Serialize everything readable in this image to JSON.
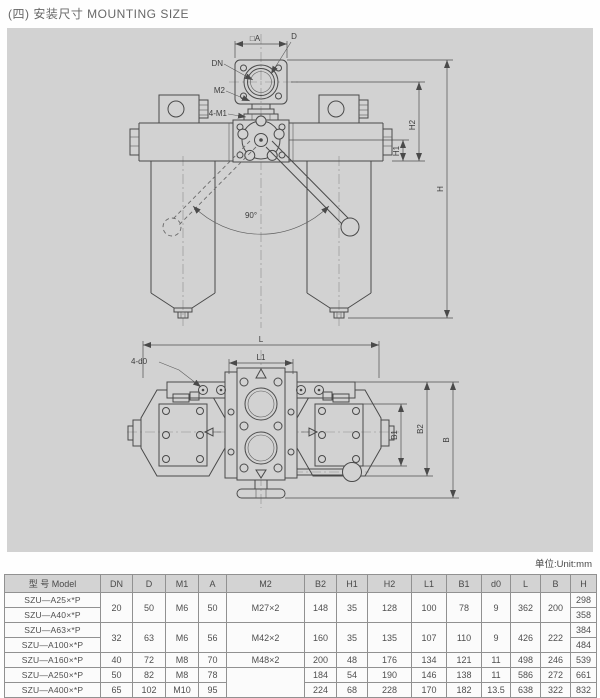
{
  "title": "(四) 安装尺寸 MOUNTING SIZE",
  "unit_note": "单位:Unit:mm",
  "colors": {
    "panel_bg": "#d2d2d2",
    "line": "#4a4a4a",
    "table_border": "#919191",
    "header_bg": "#d3d3d3"
  },
  "drawing": {
    "front_labels": {
      "square_a": "□A",
      "d": "D",
      "dn": "DN",
      "m2": "M2",
      "m1": "4-M1",
      "angle": "90°",
      "h1": "H1",
      "h2": "H2",
      "h": "H"
    },
    "plan_labels": {
      "l": "L",
      "l1": "L1",
      "d0": "4-d0",
      "b1": "B1",
      "b2": "B2",
      "b": "B"
    }
  },
  "table": {
    "headers": {
      "model": "型 号  Model",
      "dn": "DN",
      "d": "D",
      "m1": "M1",
      "a": "A",
      "m2": "M2",
      "b2": "B2",
      "h1": "H1",
      "h2": "H2",
      "l1": "L1",
      "b1": "B1",
      "d0": "d0",
      "l": "L",
      "b": "B",
      "h": "H"
    },
    "r0": {
      "model": "SZU—A25×*P",
      "dn": "20",
      "d": "50",
      "m1": "M6",
      "a": "50",
      "m2": "M27×2",
      "b2": "148",
      "h1": "35",
      "h2": "128",
      "l1": "100",
      "b1": "78",
      "d0": "9",
      "l": "362",
      "b": "200",
      "h": "298"
    },
    "r1": {
      "model": "SZU—A40×*P",
      "h": "358"
    },
    "r2": {
      "model": "SZU—A63×*P",
      "dn": "32",
      "d": "63",
      "m1": "M6",
      "a": "56",
      "m2": "M42×2",
      "b2": "160",
      "h1": "35",
      "h2": "135",
      "l1": "107",
      "b1": "110",
      "d0": "9",
      "l": "426",
      "b": "222",
      "h": "384"
    },
    "r3": {
      "model": "SZU—A100×*P",
      "h": "484"
    },
    "r4": {
      "model": "SZU—A160×*P",
      "dn": "40",
      "d": "72",
      "m1": "M8",
      "a": "70",
      "m2": "M48×2",
      "b2": "200",
      "h1": "48",
      "h2": "176",
      "l1": "134",
      "b1": "121",
      "d0": "11",
      "l": "498",
      "b": "246",
      "h": "539"
    },
    "r5": {
      "model": "SZU—A250×*P",
      "dn": "50",
      "d": "82",
      "m1": "M8",
      "a": "78",
      "b2": "184",
      "h1": "54",
      "h2": "190",
      "l1": "146",
      "b1": "138",
      "d0": "11",
      "l": "586",
      "b": "272",
      "h": "661"
    },
    "r6": {
      "model": "SZU—A400×*P",
      "dn": "65",
      "d": "102",
      "m1": "M10",
      "a": "95",
      "b2": "224",
      "h1": "68",
      "h2": "228",
      "l1": "170",
      "b1": "182",
      "d0": "13.5",
      "l": "638",
      "b": "322",
      "h": "832"
    }
  }
}
